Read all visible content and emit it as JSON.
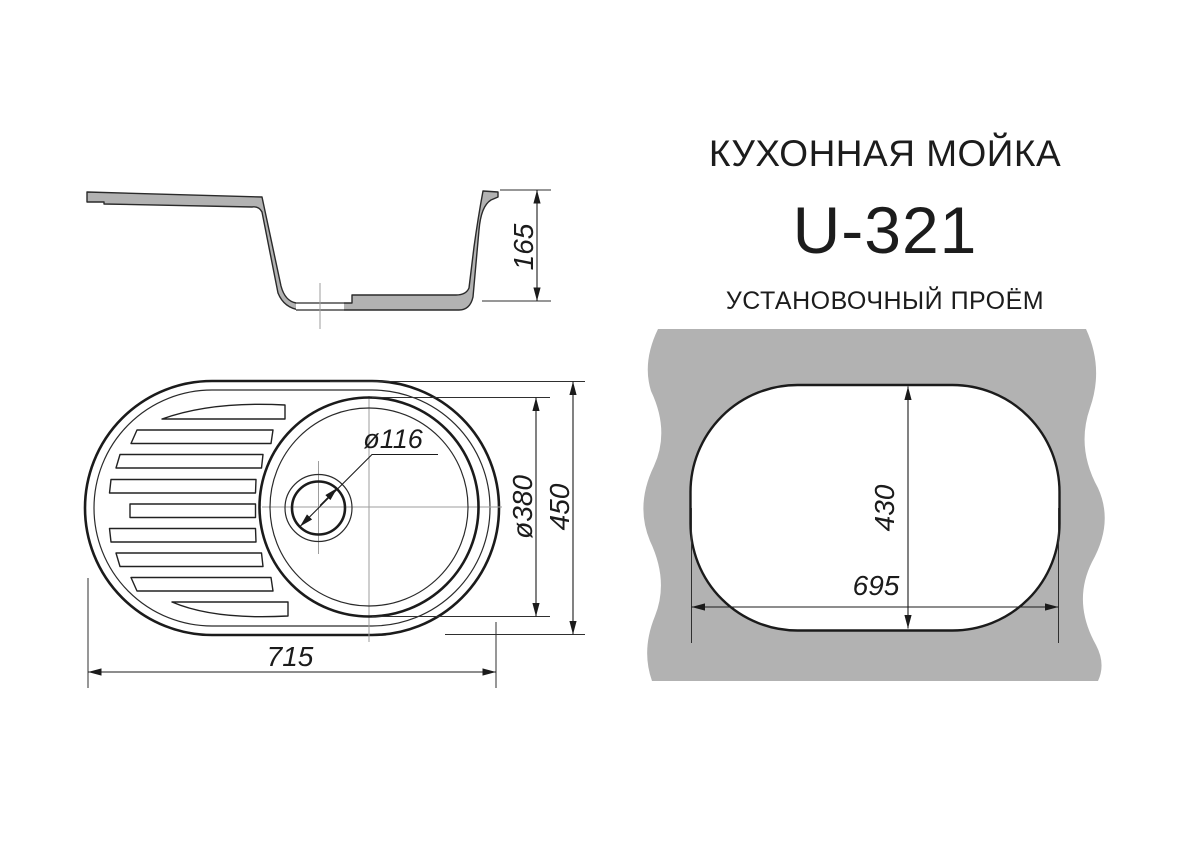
{
  "header": {
    "product_type": "КУХОННАЯ МОЙКА",
    "model": "U-321",
    "cutout_title": "УСТАНОВОЧНЫЙ ПРОЁМ"
  },
  "side_view": {
    "depth_mm": "165"
  },
  "top_view": {
    "overall_length_mm": "715",
    "overall_width_mm": "450",
    "bowl_diameter": "ø380",
    "drain_diameter": "ø116"
  },
  "cutout_view": {
    "cutout_length_mm": "695",
    "cutout_width_mm": "430"
  },
  "colors": {
    "paper": "#ffffff",
    "ink": "#1b1b1b",
    "fill_gray": "#b2b2b2",
    "centerline_gray": "#9e9e9e"
  }
}
